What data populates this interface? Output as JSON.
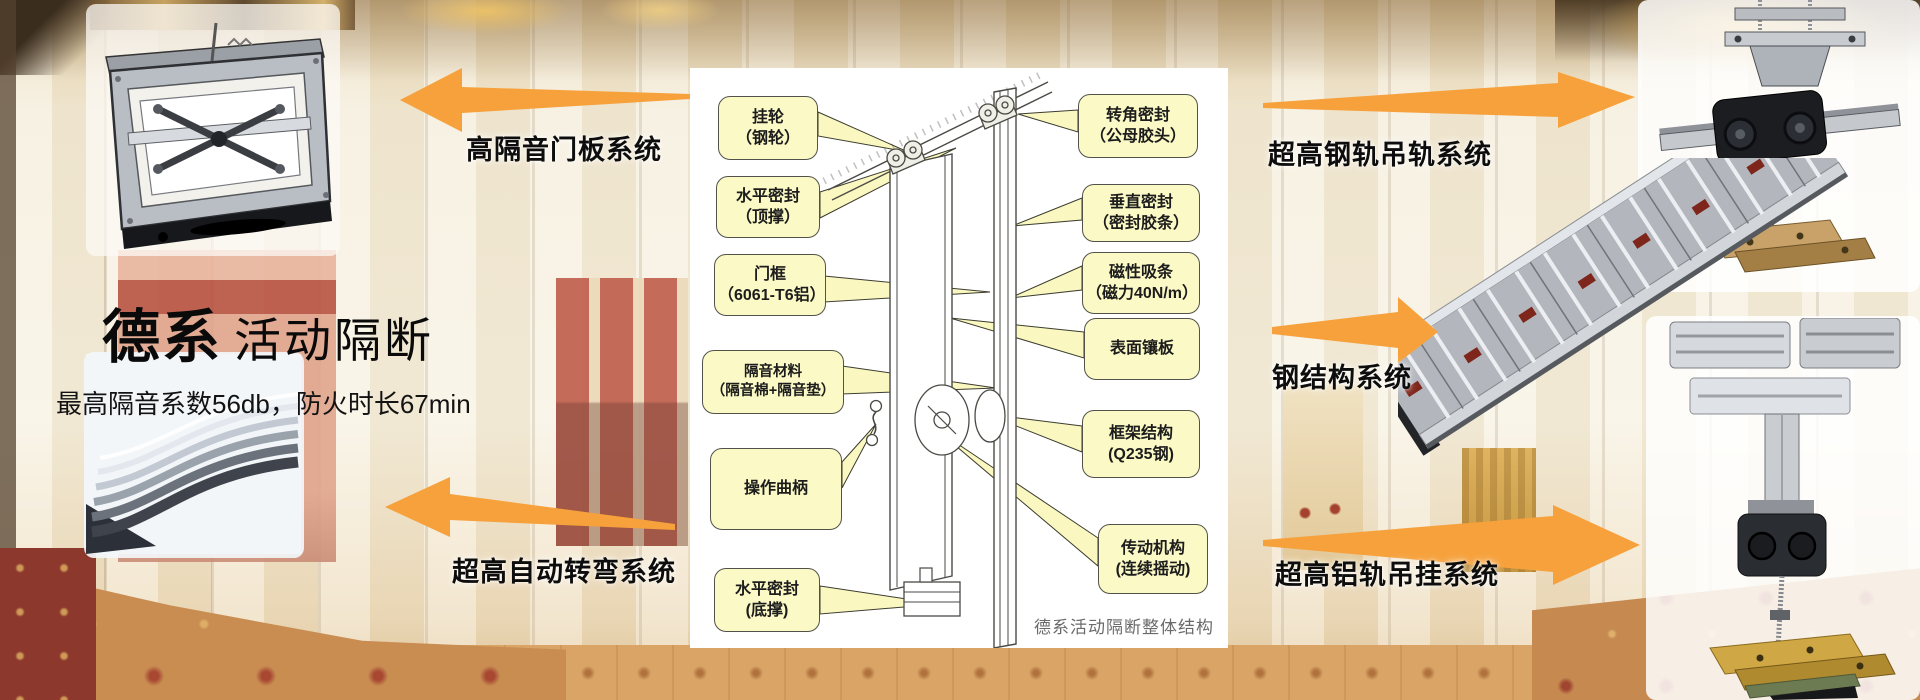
{
  "brand": {
    "series": "德系",
    "product": "活动隔断",
    "specs": "最高隔音系数56db，防火时长67min"
  },
  "systems": [
    {
      "id": "door-panel",
      "label": "高隔音门板系统",
      "direction": "left"
    },
    {
      "id": "steel-rail",
      "label": "超高钢轨吊轨系统",
      "direction": "right"
    },
    {
      "id": "steel-structure",
      "label": "钢结构系统",
      "direction": "right"
    },
    {
      "id": "auto-turn",
      "label": "超高自动转弯系统",
      "direction": "left"
    },
    {
      "id": "aluminum-rail",
      "label": "超高铝轨吊挂系统",
      "direction": "right"
    }
  ],
  "diagram": {
    "caption": "德系活动隔断整体结构",
    "callouts_left": [
      {
        "line1": "挂轮",
        "line2": "（钢轮）"
      },
      {
        "line1": "水平密封",
        "line2": "（顶撑）"
      },
      {
        "line1": "门框",
        "line2": "（6061-T6铝）"
      },
      {
        "line1": "隔音材料",
        "line2": "（隔音棉+隔音垫）"
      },
      {
        "line1": "操作曲柄",
        "line2": ""
      },
      {
        "line1": "水平密封",
        "line2": "(底撑)"
      }
    ],
    "callouts_right": [
      {
        "line1": "转角密封",
        "line2": "（公母胶头）"
      },
      {
        "line1": "垂直密封",
        "line2": "（密封胶条）"
      },
      {
        "line1": "磁性吸条",
        "line2": "（磁力40N/m）"
      },
      {
        "line1": "表面镶板",
        "line2": ""
      },
      {
        "line1": "框架结构",
        "line2": "(Q235钢)"
      },
      {
        "line1": "传动机构",
        "line2": "(连续摇动)"
      }
    ]
  },
  "colors": {
    "arrow_orange": "#F6A13B",
    "callout_bg": "#FBF9C6",
    "callout_border": "#52524A",
    "wall_cream": "#F4EBD7",
    "carpet_tan": "#D9A466",
    "accent_red_wall": "#B64E3E"
  }
}
